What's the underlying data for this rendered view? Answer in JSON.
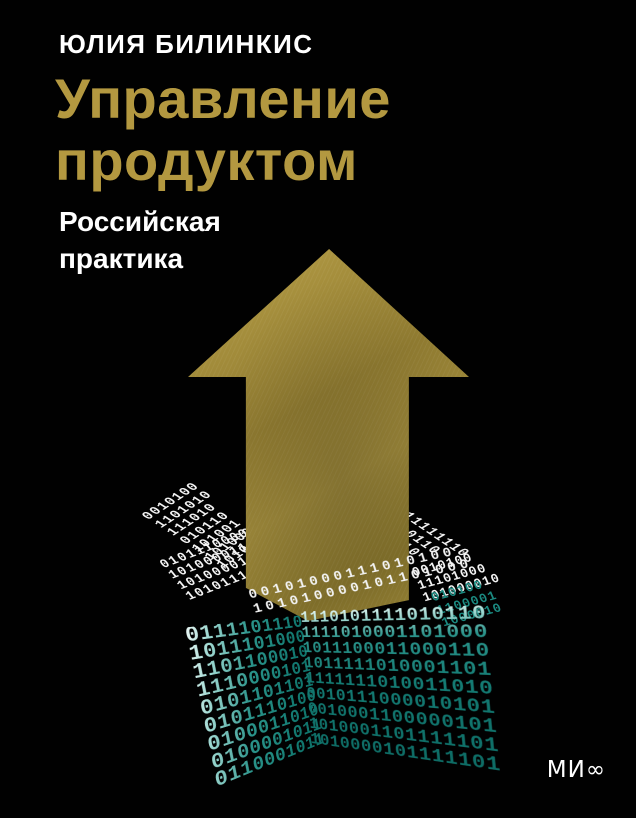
{
  "cover": {
    "author": "ЮЛИЯ БИЛИНКИС",
    "title_line1": "Управление",
    "title_line2": "продуктом",
    "subtitle_line1": "Российская",
    "subtitle_line2": "практика",
    "publisher_logo": "МИ∞",
    "colors": {
      "background": "#000000",
      "title_gold": "#b39840",
      "arrow_gold_light": "#bca64f",
      "arrow_gold_dark": "#86742c",
      "binary_teal": "#1b8a81",
      "binary_white": "#f3f3f3"
    },
    "illustration": {
      "arrow": "gold-up-arrow",
      "box": {
        "flap_left_rows": [
          "0010100",
          "1101010",
          "111010",
          "010110",
          "101001",
          "1010000",
          "1010101"
        ],
        "rim_left_rows": [
          "01011100001",
          "10100001110100",
          "101000010110",
          "101011100100"
        ],
        "flap_right_rows": [
          "111111110",
          "0010110",
          "010110",
          "01000"
        ],
        "rim_right_white_rows": [
          "0010100",
          "11101000",
          "101000010"
        ],
        "rim_right_teal_rows": [
          "010100",
          "1100001",
          "1000010"
        ],
        "rim_front_rows": [
          "00101000111010100",
          "101010000101101000"
        ],
        "left_face_rows": [
          "0111101110",
          "1011101000",
          "1101100010",
          "1110000101",
          "0101101101",
          "0101110100",
          "0100011010",
          "0100001011",
          "0110001011"
        ],
        "front_face_rows": [
          "1110101111010110",
          "1111010001101000",
          "1011100011000110",
          "1011111010001101",
          "1111111010011010",
          "0010111000010101",
          "0010001100000101",
          "1010001101111101",
          "1010000101111101"
        ]
      }
    }
  }
}
